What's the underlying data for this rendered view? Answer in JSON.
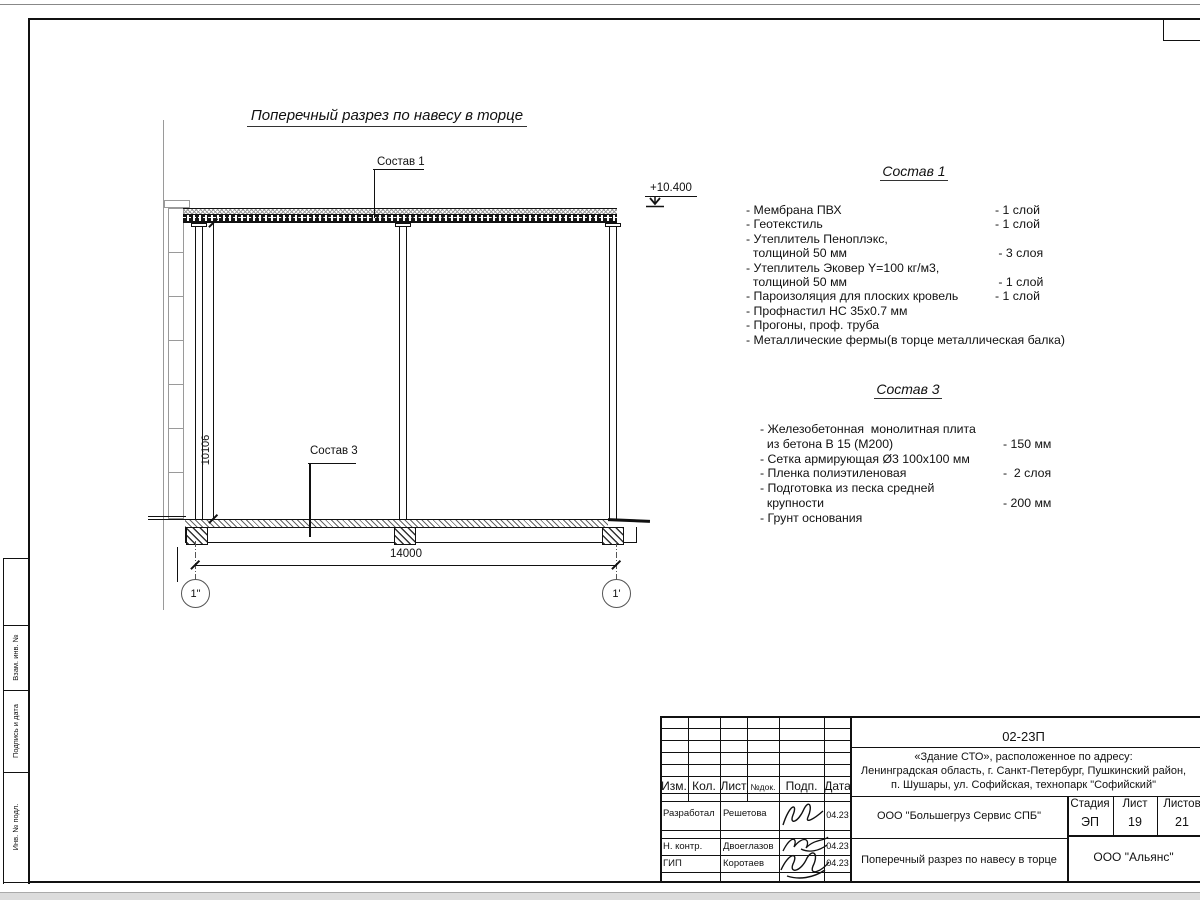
{
  "sheet": {
    "stamps_left": [
      "Взам. инв. №",
      "Подпись и дата",
      "Инв. № подл."
    ]
  },
  "drawing": {
    "title": "Поперечный разрез по навесу в торце",
    "elevation": "+10.400",
    "leader_sostav1": "Состав 1",
    "leader_sostav3": "Состав 3",
    "dim_width": "14000",
    "dim_height": "10106",
    "axis_left": "1\"",
    "axis_right": "1'"
  },
  "sostav1": {
    "heading": "Состав 1",
    "items": [
      {
        "name": "- Мембрана ПВХ",
        "value": "- 1 слой"
      },
      {
        "name": "- Геотекстиль",
        "value": "- 1 слой"
      },
      {
        "name": "- Утеплитель Пеноплэкс,",
        "value": ""
      },
      {
        "name": "  толщиной 50 мм",
        "value": " - 3 слоя"
      },
      {
        "name": "- Утеплитель Эковер Y=100 кг/м3,",
        "value": ""
      },
      {
        "name": "  толщиной 50 мм",
        "value": " - 1 слой"
      },
      {
        "name": "- Пароизоляция для плоских кровель",
        "value": "- 1 слой"
      },
      {
        "name": "- Профнастил НС 35х0.7 мм",
        "value": ""
      },
      {
        "name": "- Прогоны, проф. труба",
        "value": ""
      },
      {
        "name": "- Металлические фермы(в торце металлическая балка)",
        "value": ""
      }
    ]
  },
  "sostav3": {
    "heading": "Состав 3",
    "items": [
      {
        "name": "- Железобетонная  монолитная плита",
        "value": ""
      },
      {
        "name": "  из бетона В 15 (М200)",
        "value": "- 150 мм"
      },
      {
        "name": "- Сетка армирующая Ø3 100х100 мм",
        "value": ""
      },
      {
        "name": "- Пленка полиэтиленовая",
        "value": "-  2 слоя"
      },
      {
        "name": "- Подготовка из песка средней",
        "value": ""
      },
      {
        "name": "  крупности",
        "value": "- 200 мм"
      },
      {
        "name": "- Грунт основания",
        "value": ""
      }
    ]
  },
  "titleblock": {
    "doc_number": "02-23П",
    "address": [
      "«Здание СТО», расположенное по адресу:",
      "Ленинградская область, г. Санкт-Петербург, Пушкинский район,",
      "п. Шушары, ул. Софийская, технопарк \"Софийский\""
    ],
    "headers": {
      "izm": "Изм.",
      "kol": "Кол.",
      "list": "Лист",
      "ndok": "№док.",
      "podp": "Подп.",
      "data": "Дата"
    },
    "rows": [
      {
        "role": "Разработал",
        "name": "Решетова",
        "date": "04.23"
      },
      {
        "role": "Н. контр.",
        "name": "Двоеглазов",
        "date": "04.23"
      },
      {
        "role": "ГИП",
        "name": "Коротаев",
        "date": "04.23"
      }
    ],
    "org": "ООО \"Большегруз Сервис СПБ\"",
    "sheet_title": "Поперечный разрез по навесу в торце",
    "contractor": "ООО \"Альянс\"",
    "stage_label": "Стадия",
    "sheet_label": "Лист",
    "sheets_label": "Листов",
    "stage": "ЭП",
    "sheet_no": "19",
    "sheets_total": "21"
  }
}
